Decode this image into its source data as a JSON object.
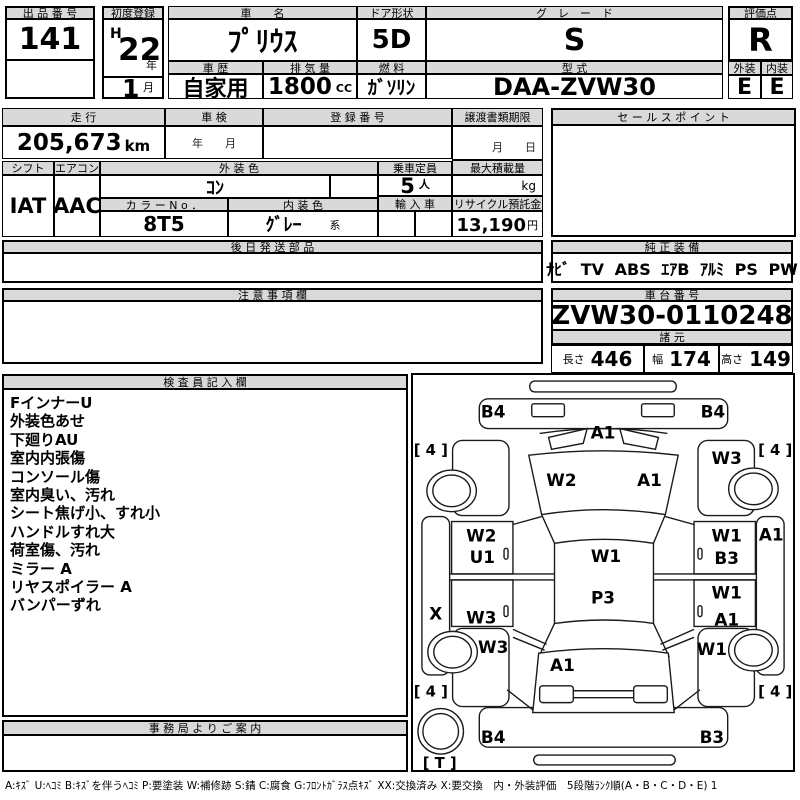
{
  "header_row": {
    "lot": {
      "label": "出 品 番 号",
      "value": "141"
    },
    "first_registration": {
      "label": "初度登録",
      "era": "H",
      "year": "22",
      "year_suffix": "年",
      "month": "1",
      "month_suffix": "月"
    },
    "car_name": {
      "label": "車　　名",
      "value": "ﾌﾟﾘｳｽ"
    },
    "door_shape": {
      "label": "ドア形状",
      "value": "5D"
    },
    "grade": {
      "label": "グ　レ　ー　ド",
      "value": "S"
    },
    "history": {
      "label": "車 歴",
      "value": "自家用"
    },
    "displacement": {
      "label": "排 気 量",
      "value": "1800",
      "unit": "CC"
    },
    "fuel": {
      "label": "燃 料",
      "value": "ｶﾞｿﾘﾝ"
    },
    "model_code": {
      "label": "型 式",
      "value": "DAA-ZVW30"
    },
    "score": {
      "label": "評価点",
      "value": "R",
      "exterior_label": "外装",
      "interior_label": "内装",
      "exterior": "E",
      "interior": "E"
    }
  },
  "status_row": {
    "mileage": {
      "label": "走 行",
      "value": "205,673",
      "unit": "km"
    },
    "inspection": {
      "label": "車 検",
      "hint": "年　　月"
    },
    "registration_no": {
      "label": "登 録 番 号",
      "value": ""
    },
    "transfer_docs": {
      "label": "譲渡書類期限",
      "hint": "月　　日"
    },
    "sales_point": {
      "label": "セ ー ル ス ポ イ ン ト",
      "value": ""
    },
    "shift": {
      "label": "シフト",
      "value": "IAT"
    },
    "aircon": {
      "label": "エアコン",
      "value": "AAC"
    },
    "exterior_color": {
      "label": "外 装 色",
      "value": "ｺﾝ"
    },
    "capacity": {
      "label": "乗車定員",
      "value": "5",
      "unit": "人"
    },
    "max_load": {
      "label": "最大積載量",
      "value": "",
      "unit": "kg"
    },
    "color_no": {
      "label": "カ ラ ー N o ．",
      "value": "8T5"
    },
    "interior_color": {
      "label": "内 装 色",
      "value": "ｸﾞﾚｰ",
      "suffix": "系"
    },
    "import_car": {
      "label": "輸 入 車",
      "value": ""
    },
    "recycle_deposit": {
      "label": "リサイクル預託金",
      "value": "13,190",
      "unit": "円"
    }
  },
  "later_parts": {
    "label": "後 日 発 送 部 品",
    "value": ""
  },
  "oem_equipment": {
    "label": "純 正 装 備",
    "value": "ﾅﾋﾞ TV ABS ｴｱB ｱﾙﾐ PS PW"
  },
  "notes": {
    "label": "注 意 事 項 欄",
    "value": ""
  },
  "chassis_no": {
    "label": "車 台 番 号",
    "value": "ZVW30-0110248"
  },
  "dimensions": {
    "label": "諸 元",
    "length_label": "長さ",
    "length": "446",
    "width_label": "幅",
    "width": "174",
    "height_label": "高さ",
    "height": "149"
  },
  "inspector_notes": {
    "label": "検 査 員 記 入 欄",
    "items": [
      "FインナーU",
      "外装色あせ",
      "下廻りAU",
      "室内内張傷",
      "コンソール傷",
      "室内臭い、汚れ",
      "シート焦げ小、すれ小",
      "ハンドルすれ大",
      "荷室傷、汚れ",
      "ミラー A",
      "リヤスポイラー A",
      "バンパーずれ"
    ]
  },
  "office_info": {
    "label": "事 務 局 よ り ご 案 内",
    "value": ""
  },
  "legend": "A:ｷｽﾞ U:ﾍｺﾐ B:ｷｽﾞを伴うﾍｺﾐ P:要塗装 W:補修跡 S:錆 C:腐食 G:ﾌﾛﾝﾄｶﾞﾗｽ点ｷｽﾞ XX:交換済み X:要交換　内・外装評価　5段階ﾗﾝｸ順(A・B・C・D・E) 1",
  "damage_map": {
    "labels": [
      "B4",
      "B4",
      "A1",
      "[ 4 ]",
      "[ 4 ]",
      "W3",
      "W2",
      "A1",
      "W2",
      "U1",
      "W1",
      "W1",
      "B3",
      "A1",
      "X",
      "W3",
      "P3",
      "W1",
      "A1",
      "W3",
      "W1",
      "A1",
      "[ 4 ]",
      "[ 4 ]",
      "B4",
      "B3",
      "[ T ]"
    ]
  },
  "colors": {
    "header_bg": "#d9d9d9",
    "border": "#000000"
  }
}
